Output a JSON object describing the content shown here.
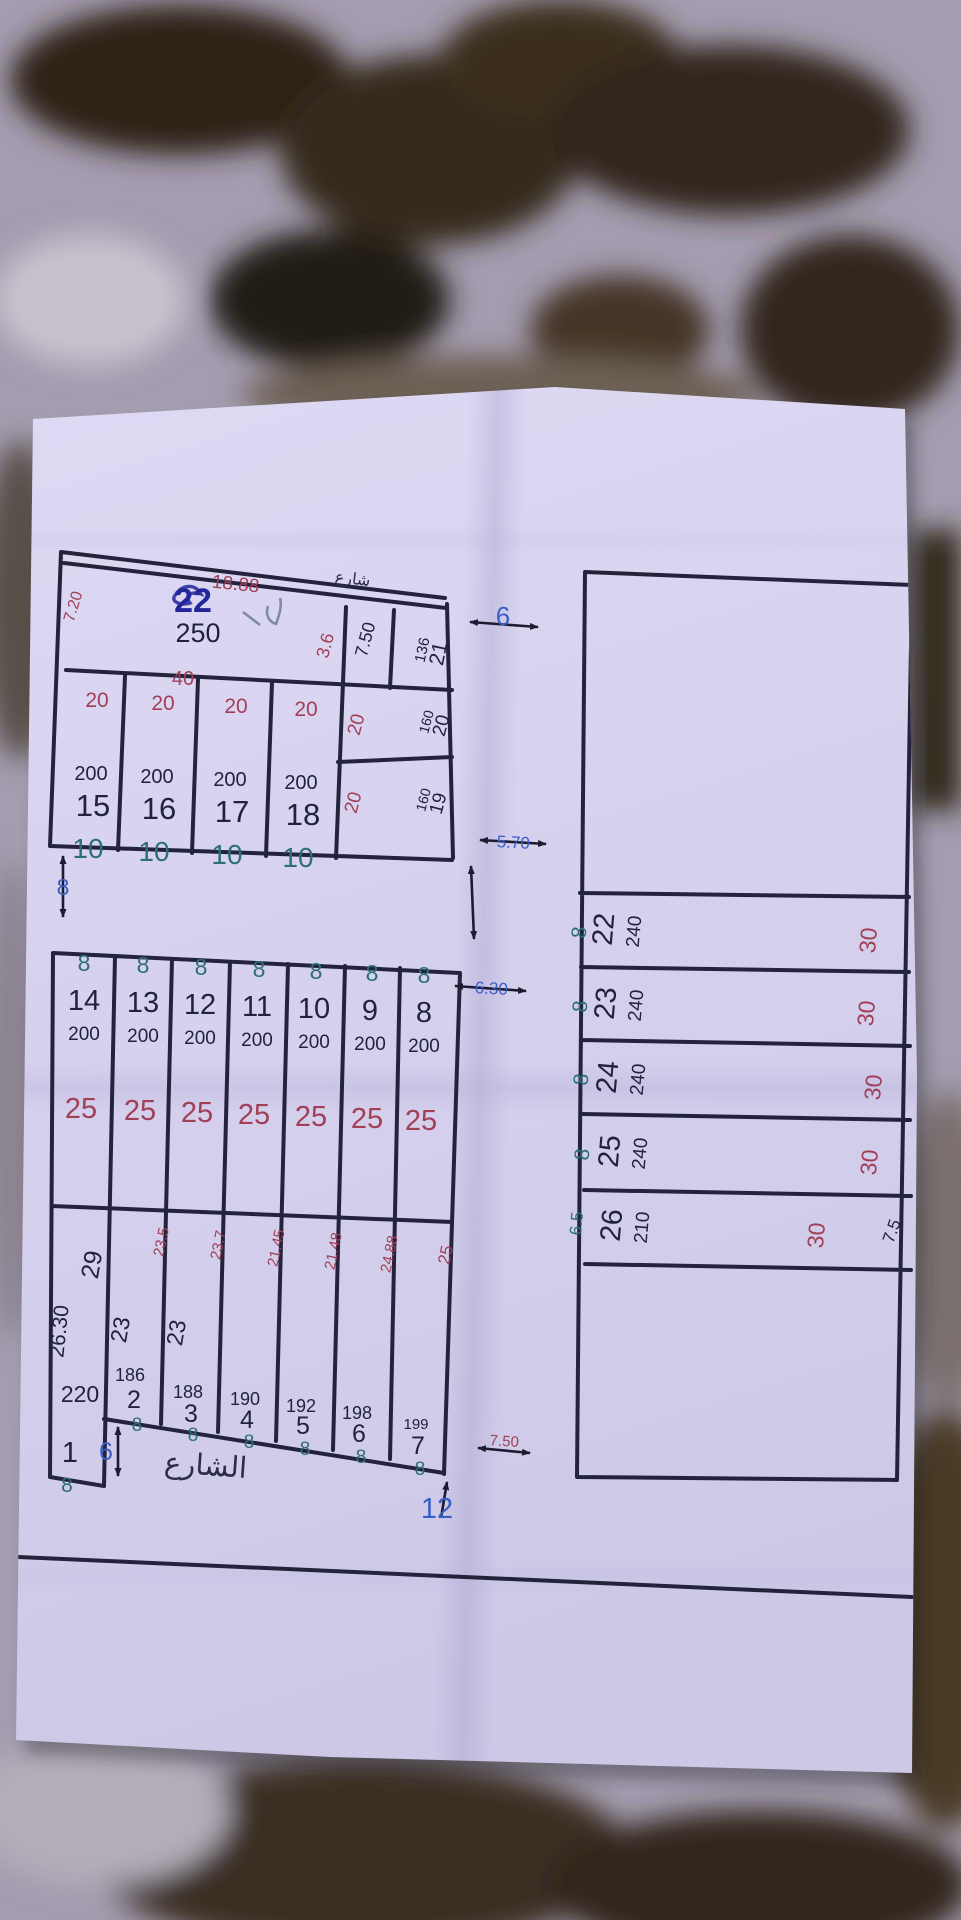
{
  "a": {
    "p22": {
      "num": "22",
      "area": "250",
      "d_top": "18.88",
      "d_left": "7.20",
      "d_bottom": "40",
      "d_right": "3.6",
      "note": "شارع"
    },
    "strip_len": "7.50",
    "p21": {
      "num": "21",
      "area": "136"
    },
    "p20": {
      "num": "20",
      "area": "160",
      "w": "20"
    },
    "p19": {
      "num": "19",
      "area": "160",
      "w": "20"
    },
    "row": [
      {
        "num": "15",
        "area": "200",
        "top": "20",
        "bot": "10"
      },
      {
        "num": "16",
        "area": "200",
        "top": "20",
        "bot": "10"
      },
      {
        "num": "17",
        "area": "200",
        "top": "20",
        "bot": "10"
      },
      {
        "num": "18",
        "area": "200",
        "top": "20",
        "bot": "10"
      }
    ],
    "scribble_mark": "٢٧"
  },
  "b": {
    "cols": [
      {
        "num": "14",
        "area": "200",
        "len": "25",
        "w": "8"
      },
      {
        "num": "13",
        "area": "200",
        "len": "25",
        "w": "8"
      },
      {
        "num": "12",
        "area": "200",
        "len": "25",
        "w": "8"
      },
      {
        "num": "11",
        "area": "200",
        "len": "25",
        "w": "8"
      },
      {
        "num": "10",
        "area": "200",
        "len": "25",
        "w": "8"
      },
      {
        "num": "9",
        "area": "200",
        "len": "25",
        "w": "8"
      },
      {
        "num": "8",
        "area": "200",
        "len": "25",
        "w": "8"
      }
    ],
    "p1": {
      "num": "1",
      "area": "220",
      "d_left": "26.30",
      "d_top": "29",
      "w": "8"
    },
    "lower": [
      {
        "num": "2",
        "area": "186",
        "dim": "23.5",
        "side": "23",
        "w": "8"
      },
      {
        "num": "3",
        "area": "188",
        "dim": "23.7",
        "side": "23",
        "w": "8"
      },
      {
        "num": "4",
        "area": "190",
        "dim": "21.45",
        "w": "8"
      },
      {
        "num": "5",
        "area": "192",
        "dim": "21.48",
        "w": "8"
      },
      {
        "num": "6",
        "area": "198",
        "dim": "24.88",
        "w": "8"
      },
      {
        "num": "7",
        "area": "199",
        "dim": "25",
        "w": "8"
      }
    ],
    "street": "الشارع",
    "m6": "6",
    "m12": "12",
    "m75": "7.50"
  },
  "c": {
    "rows": [
      {
        "num": "22",
        "area": "240",
        "w": "8",
        "len": "30"
      },
      {
        "num": "23",
        "area": "240",
        "w": "8",
        "len": "30"
      },
      {
        "num": "24",
        "area": "240",
        "w": "8",
        "len": "30"
      },
      {
        "num": "25",
        "area": "240",
        "w": "8",
        "len": "30"
      },
      {
        "num": "26",
        "area": "210",
        "w": "6.5",
        "len": "30"
      }
    ],
    "corner": "7.5"
  },
  "mk": {
    "g6": "6",
    "g570": "5.70",
    "g630": "6.30",
    "g8": "8"
  }
}
